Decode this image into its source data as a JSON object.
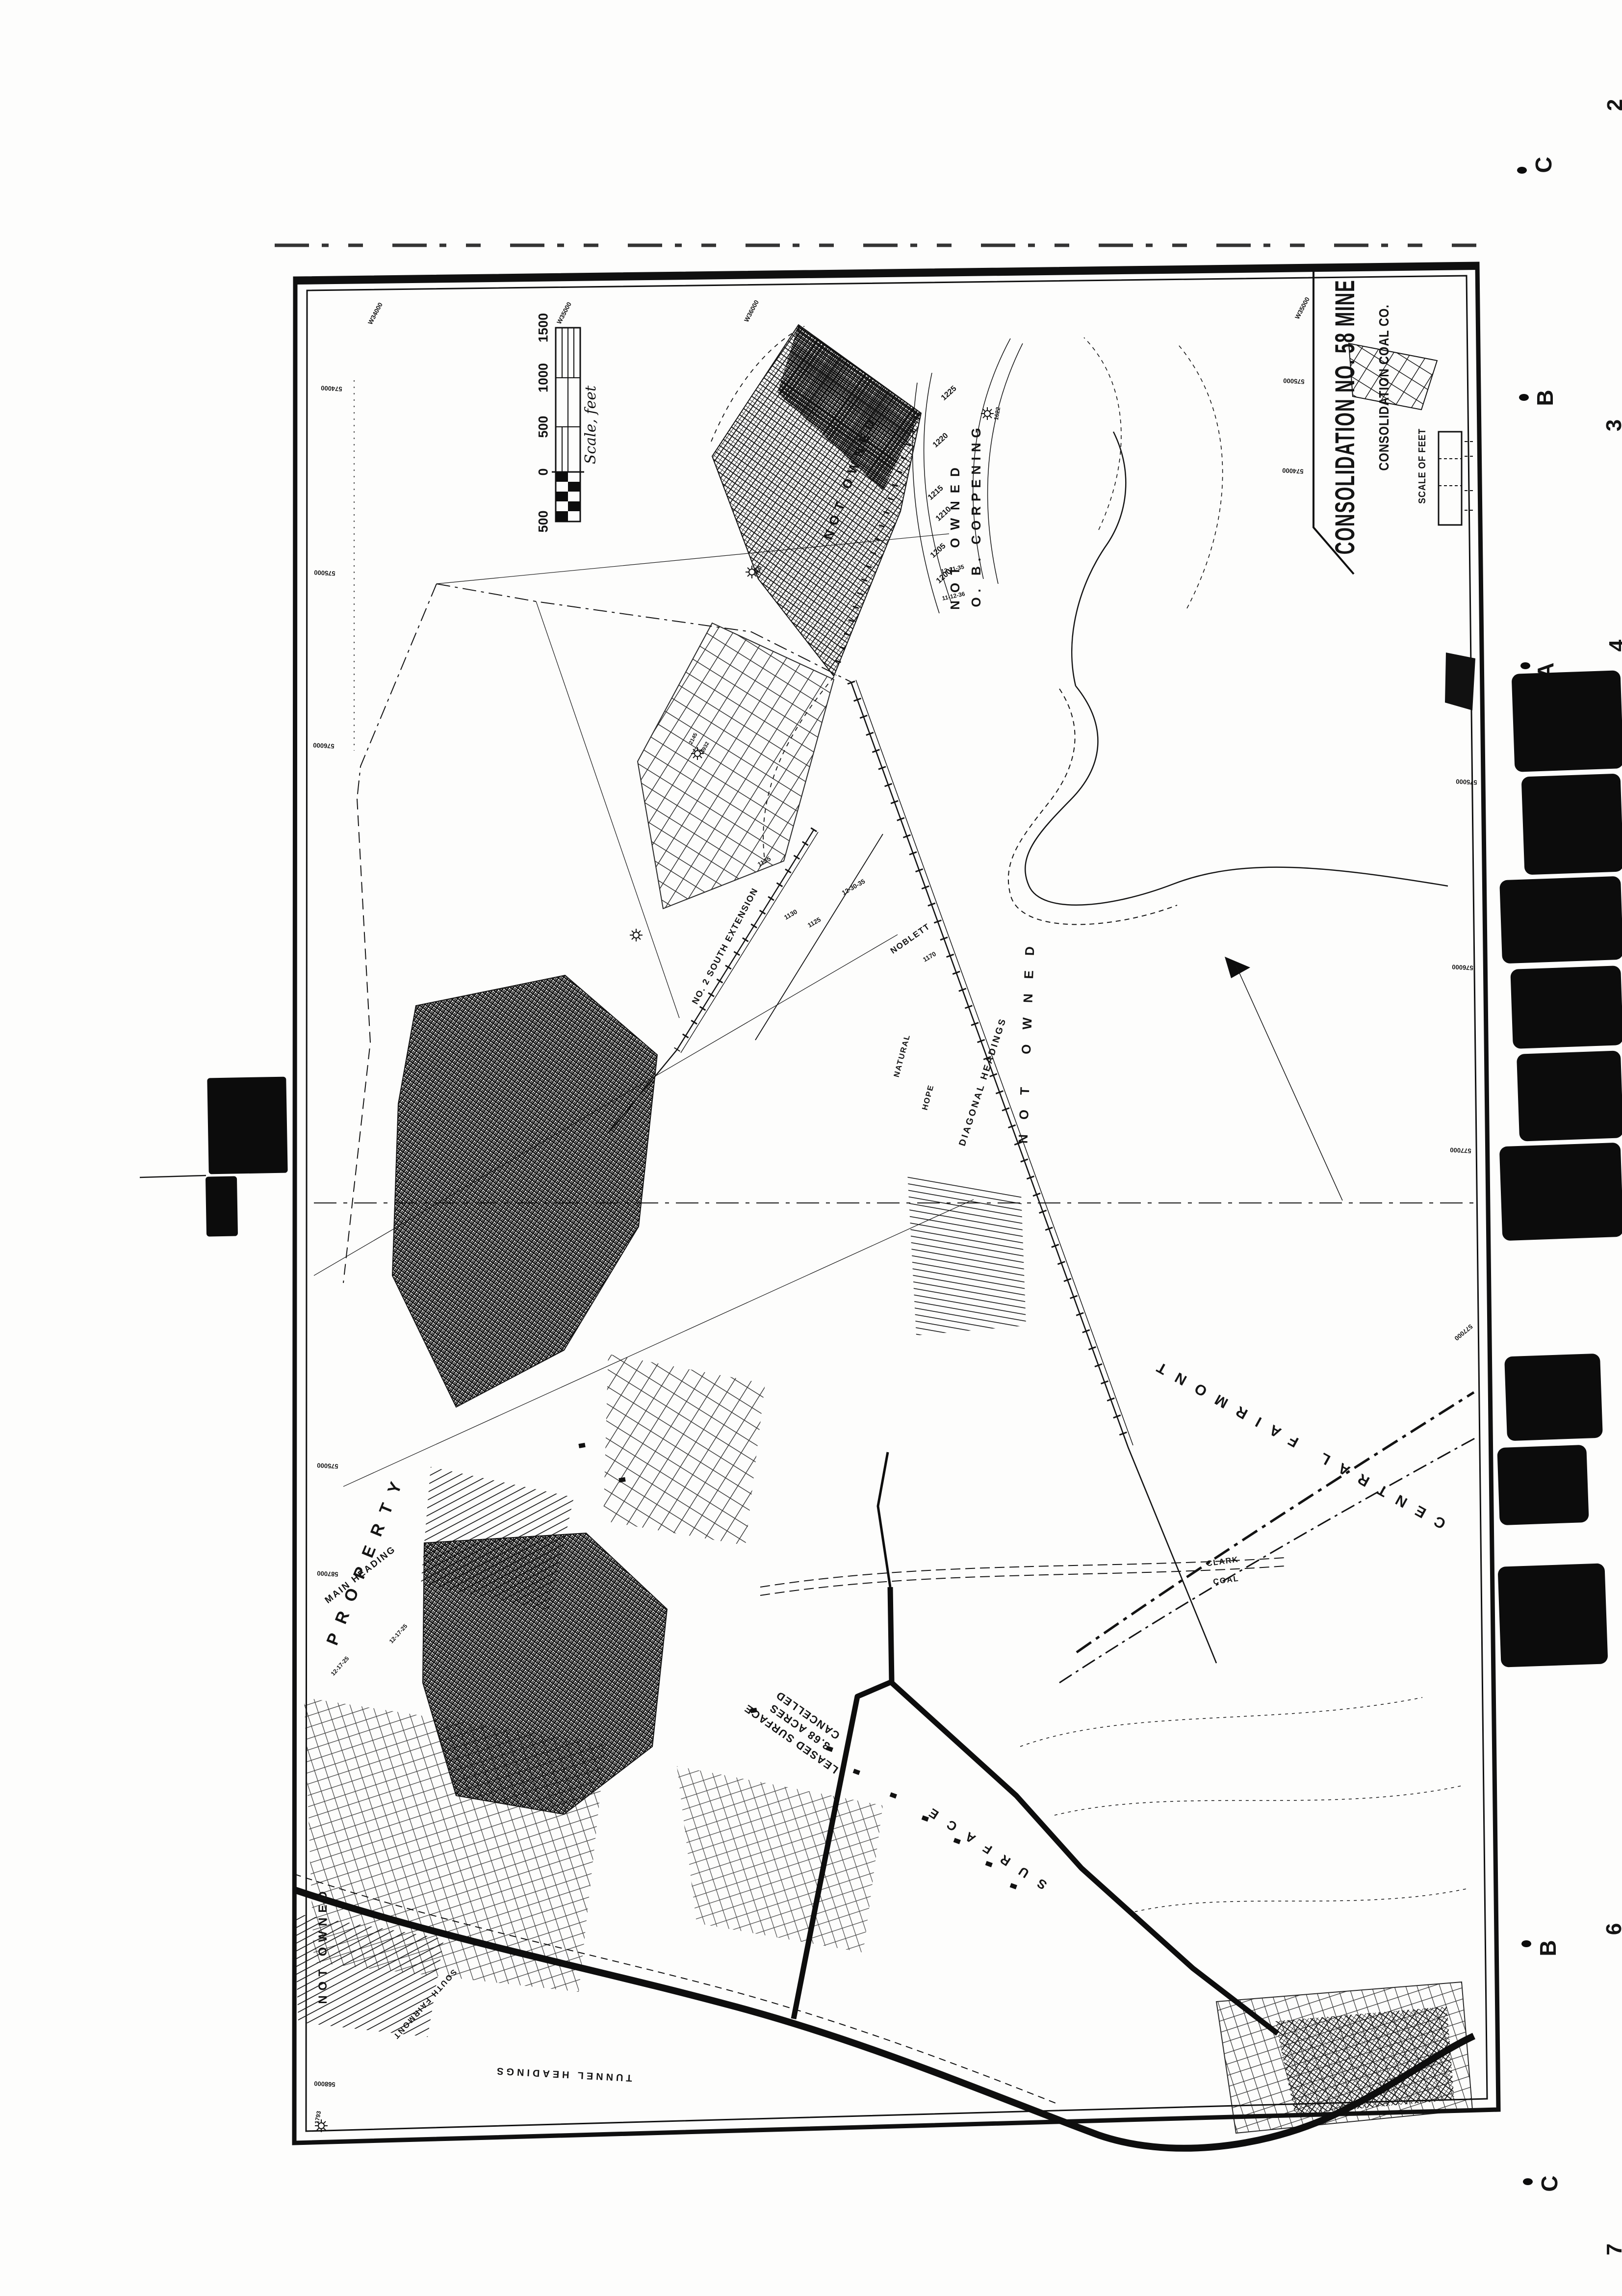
{
  "title_block": {
    "mine_name": "CONSOLIDATION NO. 58 MINE",
    "company_name": "CONSOLIDATION COAL CO.",
    "scale_heading": "SCALE OF FEET"
  },
  "scale_bar": {
    "ticks": [
      "1500",
      "1000",
      "500",
      "0",
      "500"
    ],
    "caption": "Scale, feet"
  },
  "registration": {
    "letters": [
      "C",
      "B",
      "A",
      "B",
      "C"
    ],
    "numbers": [
      "2",
      "3",
      "4",
      "6",
      "7"
    ]
  },
  "labels": {
    "not_owned_a": "NOT OWNED",
    "not_owned_b": "NOT OWNED",
    "not_owned_c": "NOT OWNED",
    "not_owned_d": "NOT OWNED",
    "owner": "O. B. CORPENING",
    "property": "PROPERTY",
    "main_heading": "MAIN HEADING",
    "south_extension": "NO. 2 SOUTH EXTENSION",
    "noblett": "NOBLETT",
    "diagonal_headings": "DIAGONAL HEADINGS",
    "natural": "NATURAL",
    "hope": "HOPE",
    "leased_line1": "LEASED SURFACE",
    "leased_line2": "3.68 ACRES",
    "leased_line3": "CANCELLED",
    "surface": "SURFACE",
    "tunnel_headings": "TUNNEL HEADINGS",
    "south_fairmont": "SOUTH FAIRMONT",
    "central_fairmont": "CENTRAL FAIRMONT",
    "clark": "CLARK",
    "coal": "COAL"
  },
  "contours": [
    "1225",
    "1220",
    "1215",
    "1210",
    "1205",
    "1200"
  ],
  "elevations": [
    "1135",
    "1130",
    "1125",
    "1170"
  ],
  "dates": [
    "12-21-35",
    "11-12-36",
    "12-17-25",
    "12-17-25",
    "12-30-35"
  ],
  "spot_values": {
    "s750": "750",
    "s1622": "1622",
    "s2145": "2145",
    "s4932": "4932",
    "s1793": "1793"
  },
  "grid_coords": {
    "top": [
      "W34000",
      "W35000",
      "W36000"
    ],
    "right": [
      "575000",
      "576000",
      "577000",
      "577000"
    ],
    "left": [
      "574000",
      "575000",
      "576000",
      "575000",
      "587000",
      "568000"
    ],
    "inner": [
      "W35000",
      "575000",
      "574000"
    ]
  }
}
